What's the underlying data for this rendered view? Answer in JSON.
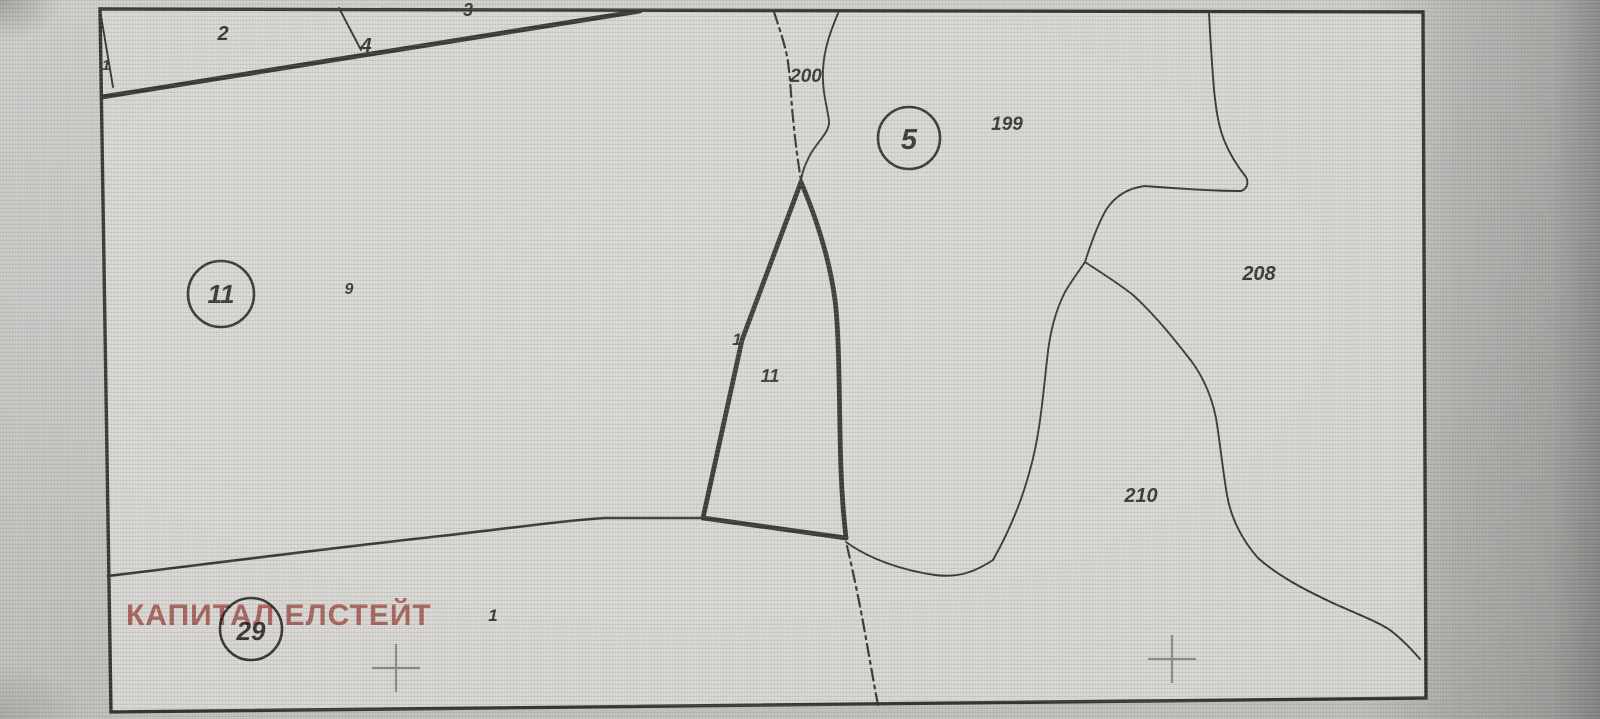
{
  "map": {
    "watermark_text": "КАПИТАЛ ЕЛСТЕЙТ",
    "circled_parcels": {
      "c11": "11",
      "c5": "5",
      "c29": "29"
    },
    "parcel_labels": {
      "topleft_1": "1",
      "p2": "2",
      "p4": "4",
      "p3": "3",
      "p200": "200",
      "p199": "199",
      "p9": "9",
      "mid_1": "1",
      "mid_11": "11",
      "p208": "208",
      "p210": "210",
      "bottom_1": "1"
    }
  },
  "colors": {
    "line": "#262420",
    "paper": "#d8d6d2",
    "watermark": "#b5524b",
    "cross": "#85837f"
  }
}
